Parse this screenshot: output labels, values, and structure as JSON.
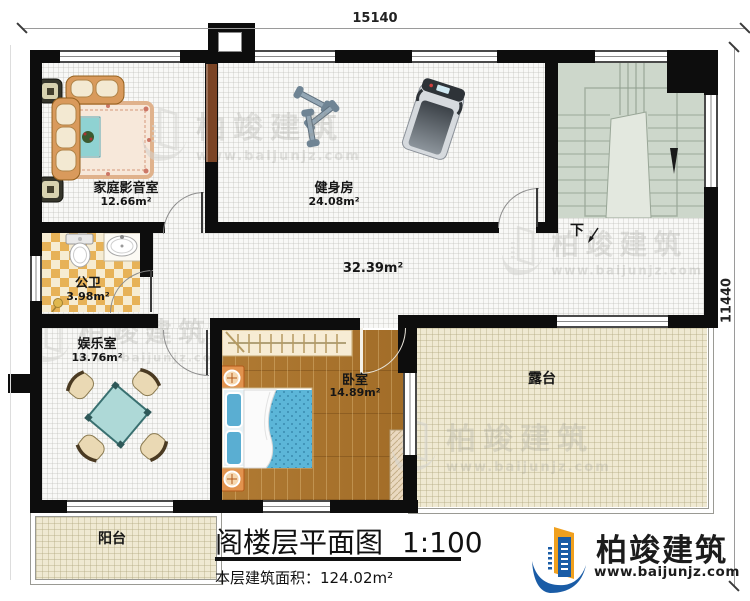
{
  "plan": {
    "title": "阁楼层平面图",
    "scale": "1:100",
    "area_label": "本层建筑面积：",
    "area_value": "124.02m²"
  },
  "dimensions": {
    "top": "15140",
    "right": "11440"
  },
  "rooms": {
    "home_theater": {
      "name": "家庭影音室",
      "area": "12.66m²"
    },
    "gym": {
      "name": "健身房",
      "area": "24.08m²"
    },
    "hall": {
      "area": "32.39m²"
    },
    "bathroom": {
      "name": "公卫",
      "area": "3.98m²"
    },
    "entertainment": {
      "name": "娱乐室",
      "area": "13.76m²"
    },
    "bedroom": {
      "name": "卧室",
      "area": "14.89m²"
    },
    "terrace": {
      "name": "露台"
    },
    "balcony": {
      "name": "阳台"
    },
    "stairs": {
      "direction_label": "下"
    }
  },
  "branding": {
    "company": "柏竣建筑",
    "website": "www.baijunjz.com"
  },
  "watermark": {
    "company": "柏竣建筑",
    "website": "www.baijunjz.com"
  },
  "colors": {
    "wall": "#0d0d0d",
    "wood_floor": "#a9742e",
    "tile_checker_dark": "#e7b257",
    "tile_checker_light": "#f6ecd2",
    "terrace_floor": "#efe9d2",
    "stair_floor": "#cdd7cb",
    "bed_blue": "#5cb6d8",
    "logo_blue": "#1a5ca6",
    "logo_orange": "#f0a01e"
  }
}
